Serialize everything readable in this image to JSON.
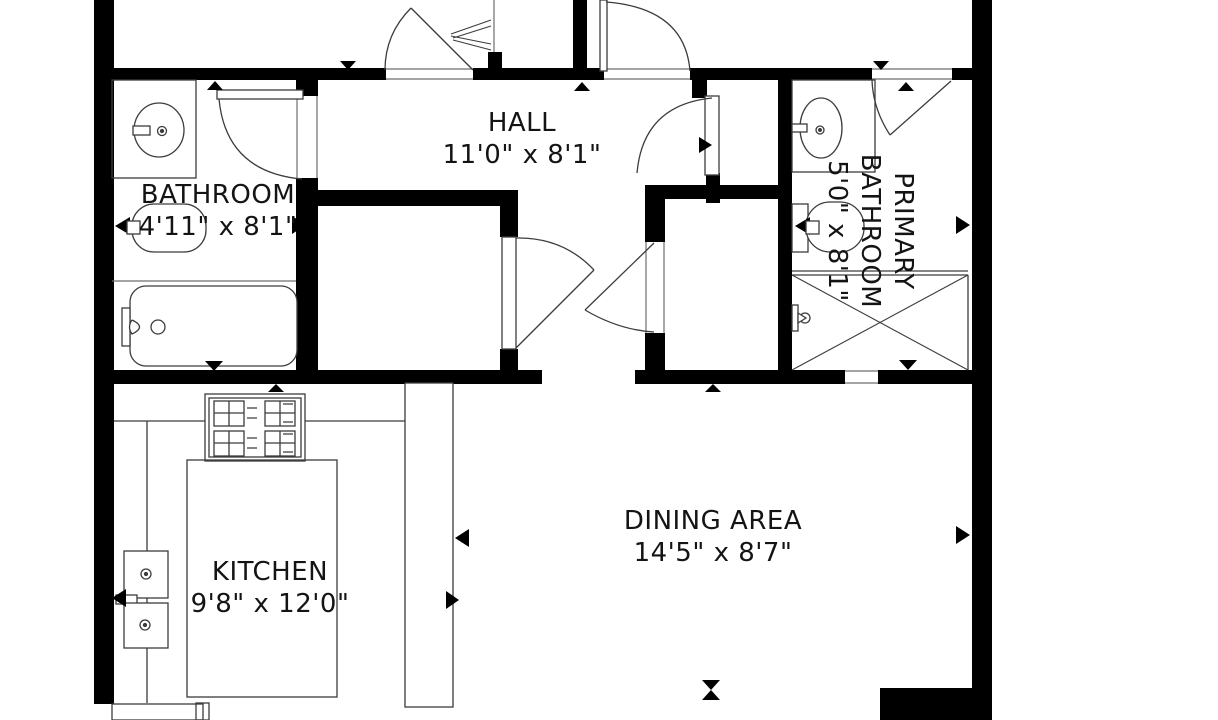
{
  "floorplan": {
    "background": "#ffffff",
    "wall_color": "#000000",
    "line_color": "#3c3c3c",
    "rooms": {
      "hall": {
        "name": "HALL",
        "dimensions": "11'0\" x 8'1\""
      },
      "bathroom": {
        "name": "BATHROOM",
        "dimensions": "4'11\" x 8'1\""
      },
      "primary_bathroom": {
        "line1": "PRIMARY",
        "line2": "BATHROOM",
        "dimensions": "5'0\" x 8'1\""
      },
      "kitchen": {
        "name": "KITCHEN",
        "dimensions": "9'8\" x 12'0\""
      },
      "dining": {
        "name": "DINING AREA",
        "dimensions": "14'5\" x 8'7\""
      }
    }
  }
}
